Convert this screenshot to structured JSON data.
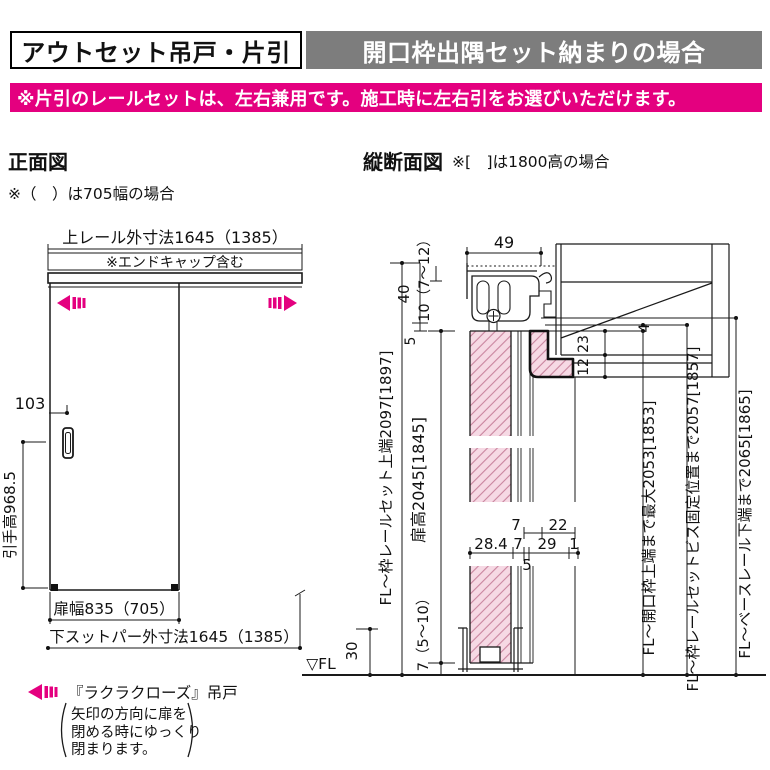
{
  "header": {
    "title_left": "アウトセット吊戸・片引",
    "title_right": "開口枠出隅セット納まりの場合",
    "notice": "※片引のレールセットは、左右兼用です。施工時に左右引をお選びいただけます。"
  },
  "front_view": {
    "title": "正面図",
    "note": "※（　）は705幅の場合",
    "dims": {
      "top_rail": "上レール外寸法1645（1385）",
      "endcap": "※エンドキャップ含む",
      "offset_103": "103",
      "handle_height": "引手高968.5",
      "door_width": "扉幅835（705）",
      "bottom_stopper": "下スットパー外寸法1645（1385）"
    },
    "legend": {
      "label": "『ラクラクローズ』吊戸",
      "note_line1": "矢印の方向に扉を",
      "note_line2": "閉める時にゆっくり",
      "note_line3": "閉まります。"
    }
  },
  "section_view": {
    "title": "縦断面図",
    "note": "※[　]は1800高の場合",
    "fl_mark": "▽FL",
    "dims": {
      "rail_width": "49",
      "rail_height": "40",
      "clearance_top": "10（7～12）",
      "gap_rail_door": "5",
      "fl_rail_top": "FL～枠レールセット上端2097[1897]",
      "door_height": "扉高2045[1845]",
      "gap_floor": "7（5～10）",
      "guide_height": "30",
      "offset_4": "4",
      "frame_23": "23",
      "frame_12": "12",
      "t7a": "7",
      "t22": "22",
      "t28_4": "28.4",
      "t7b": "7",
      "t29": "29",
      "t1": "1",
      "t5": "5",
      "fl_frame_top": "FL～開口枠上端まで最大2053[1853]",
      "fl_screw_pos": "FL～枠レールセットビス固定位置まで2057[1857]",
      "fl_base_rail": "FL～ベースレール下端まで2065[1865]"
    }
  },
  "colors": {
    "accent_pink": "#e4007f",
    "header_gray": "#7d7d7d",
    "hatch_fill": "#f6d9e4",
    "hatch_line": "#c9849e",
    "line": "#1a1a1a"
  }
}
